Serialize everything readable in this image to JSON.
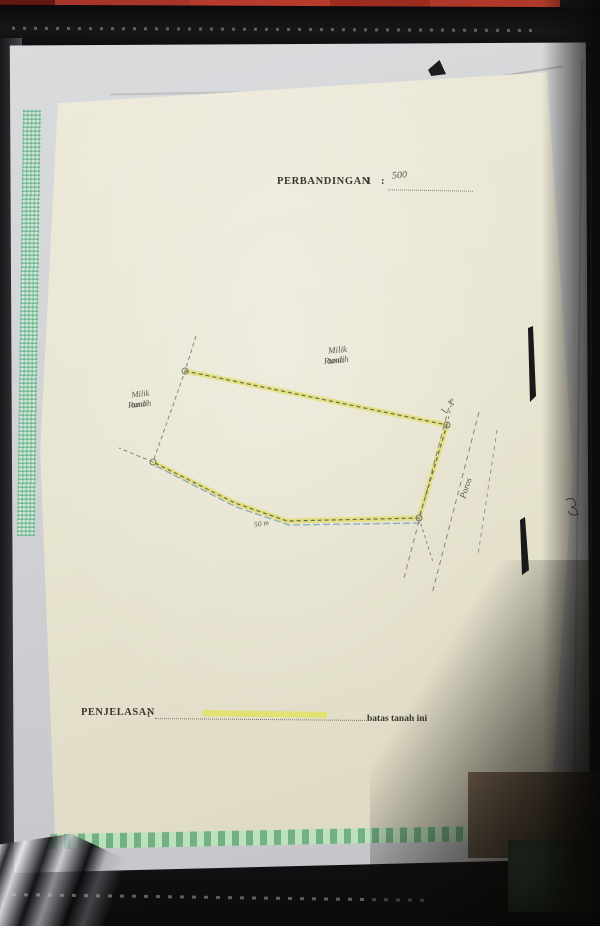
{
  "document": {
    "title": {
      "label": "PERBANDINGAN",
      "number": "1",
      "colon": ":",
      "value": "500"
    },
    "legend": {
      "label": "PENJELASAN",
      "colon": ":",
      "meaning": "batas tanah ini"
    },
    "sketch": {
      "labels": {
        "owner_top_line1": "Milik tanah",
        "owner_top_line2": "Rusdi",
        "owner_left_line1": "Milik tanah",
        "owner_left_line2": "Rusdi",
        "road": "Poros",
        "edge_note": "50 m"
      },
      "geometry": {
        "boundary_points": "185,371 447,425 419,518 287,521 235,503 153,462",
        "water_points": "156,466 236,507 289,525 420,523",
        "left_edge_points": "196,336 185,371 153,462 119,448",
        "ext_top_right": "447,425 453,396",
        "ext_bottom_right": "419,518 433,562",
        "road_line_1": "451,399 404,578",
        "road_line_2": "479,412 432,594",
        "road_line_3": "497,430 478,555"
      },
      "colors": {
        "boundary_highlight": "#e0df6c",
        "ink_line": "#6b685a",
        "water_line": "#8cb0c9"
      }
    }
  }
}
